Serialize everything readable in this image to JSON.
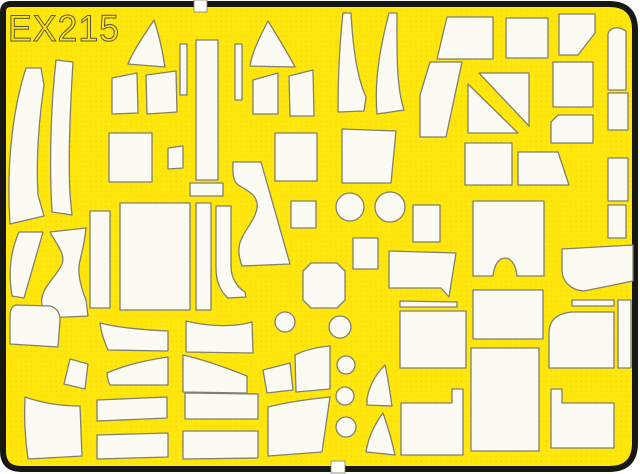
{
  "sheet": {
    "code": "EX215",
    "colors": {
      "page_background": "#ffffff",
      "sheet_yellow": "#ffe70d",
      "sheet_dot": "#f2d606",
      "part_fill": "#fbfbf3",
      "part_outline": "#80806f",
      "border_black": "#181812",
      "code_stroke": "#55554a"
    },
    "notches": [
      {
        "name": "top-edge-notch",
        "x": 194,
        "y": 0,
        "w": 13,
        "h": 12
      },
      {
        "name": "bottom-edge-notch",
        "x": 331,
        "y": 461,
        "w": 14,
        "h": 12
      }
    ],
    "parts": [
      {
        "name": "mask-crescent-left",
        "d": "M26,68 L41,68 L44,85 C39,120 36,160 38,195 L44,216 L10,224 C6,165 13,108 26,68 Z"
      },
      {
        "name": "mask-curved-strip-left",
        "d": "M56,60 L73,62 C70,110 68,155 70,195 L72,215 L52,212 C49,160 51,105 56,60 Z"
      },
      {
        "name": "mask-trapezoid-1",
        "d": "M112,78 L137,73 L138,113 L112,114 Z"
      },
      {
        "name": "mask-trapezoid-2",
        "d": "M146,75 L176,71 L177,112 L147,114 Z"
      },
      {
        "name": "mask-fin-1",
        "d": "M154,20 C143,37 133,51 128,64 L165,67 C162,47 158,32 154,20 Z"
      },
      {
        "name": "mask-thin-strip-1",
        "d": "M180,44 L187,44 L187,95 L180,95 Z"
      },
      {
        "name": "mask-thin-strip-2",
        "d": "M235,44 L242,44 L242,100 L235,100 Z"
      },
      {
        "name": "mask-tall-rect",
        "d": "M196,40 L218,40 L218,180 L196,180 Z"
      },
      {
        "name": "mask-fin-2",
        "d": "M268,21 C259,38 252,53 250,66 L295,67 C286,50 276,34 268,21 Z"
      },
      {
        "name": "mask-trapezoid-3",
        "d": "M253,80 L278,73 L278,114 L253,114 Z"
      },
      {
        "name": "mask-trapezoid-4",
        "d": "M289,76 L313,70 L314,116 L290,116 Z"
      },
      {
        "name": "mask-feather-1",
        "d": "M343,13 L351,13 C353,50 358,80 366,97 L364,111 L338,112 C338,72 340,40 343,13 Z"
      },
      {
        "name": "mask-feather-2",
        "d": "M389,13 L397,13 C397,52 396,85 404,110 L377,114 C374,78 381,44 389,13 Z"
      },
      {
        "name": "mask-rect-mid-top",
        "d": "M275,133 L317,133 L317,181 L275,181 Z"
      },
      {
        "name": "mask-trap-rect",
        "d": "M342,129 L396,131 L391,183 L342,183 Z"
      },
      {
        "name": "mask-diag-quad-a",
        "d": "M447,17 L493,17 L493,59 L437,59 Z"
      },
      {
        "name": "mask-square-b",
        "d": "M506,18 L548,18 L548,58 L506,58 Z"
      },
      {
        "name": "mask-pentagon-c",
        "d": "M559,14 L595,14 L595,33 L578,55 L559,55 Z"
      },
      {
        "name": "mask-diag-block-d",
        "d": "M420,137 L420,95 L430,62 L462,62 L446,137 Z"
      },
      {
        "name": "mask-diag-triangle-upper",
        "d": "M479,73 L529,73 L529,126 Z"
      },
      {
        "name": "mask-diag-triangle-lower",
        "d": "M468,84 L468,133 L518,133 Z"
      },
      {
        "name": "mask-corner-cut-quad",
        "d": "M558,115 L593,115 L593,143 L551,143 L551,122 Z"
      },
      {
        "name": "mask-rect-under-diag",
        "d": "M465,143 L512,143 L512,185 L465,185 Z"
      },
      {
        "name": "mask-slant-quad",
        "d": "M518,152 L558,152 L569,185 L518,185 Z"
      },
      {
        "name": "mask-edge-strip-1",
        "d": "M608,34 C609,29 614,27 620,28 L626,31 L626,90 L608,90 Z"
      },
      {
        "name": "mask-edge-strip-2",
        "d": "M608,93 L628,93 L628,130 L608,130 Z"
      },
      {
        "name": "mask-square-right",
        "d": "M553,62 L593,62 L593,107 L553,107 Z"
      },
      {
        "name": "mask-edge-strip-3",
        "d": "M608,158 L628,158 L628,201 L608,201 Z"
      },
      {
        "name": "mask-edge-strip-4",
        "d": "M608,205 L626,205 L626,238 L608,238 Z"
      },
      {
        "name": "mask-rect-above-square",
        "d": "M109,133 L152,133 L152,182 L109,182 Z"
      },
      {
        "name": "mask-small-trap",
        "d": "M168,148 L183,146 L183,168 L168,169 Z"
      },
      {
        "name": "mask-small-hrect",
        "d": "M190,183 L223,183 L223,196 L190,196 Z"
      },
      {
        "name": "mask-big-square",
        "d": "M120,203 L190,203 L190,310 L120,310 Z"
      },
      {
        "name": "mask-strip-a",
        "d": "M196,203 L211,203 L211,310 L196,310 Z"
      },
      {
        "name": "mask-strip-b-hook",
        "d": "M216,206 L231,206 L231,266 C231,278 237,287 245,292 L246,297 L228,298 C220,291 216,281 216,268 Z"
      },
      {
        "name": "mask-horn",
        "d": "M233,162 L261,162 L290,264 L242,266 C239,258 237,249 241,240 C246,228 255,220 257,208 C259,194 245,190 237,184 C232,179 233,170 233,162 Z"
      },
      {
        "name": "mask-small-square",
        "d": "M291,201 L316,201 L316,228 L291,228 Z"
      },
      {
        "name": "mask-circle-large-1",
        "cx": 350,
        "cy": 207,
        "r": 14
      },
      {
        "name": "mask-circle-large-2",
        "cx": 390,
        "cy": 207,
        "r": 15
      },
      {
        "name": "mask-small-vrect",
        "d": "M353,238 L378,238 L378,269 L353,269 Z"
      },
      {
        "name": "mask-octagon",
        "d": "M311,263 L337,263 L345,271 L345,300 L337,308 L311,308 L303,300 L303,271 Z"
      },
      {
        "name": "mask-notched-bar",
        "d": "M389,251 L456,253 L449,297 L441,288 L389,288 Z"
      },
      {
        "name": "mask-rect-center-right",
        "d": "M413,205 L440,205 L440,242 L413,242 Z"
      },
      {
        "name": "mask-arch-square",
        "d": "M473,201 L544,201 L544,276 L517,276 C516,265 511,258 505,258 C499,258 494,265 493,276 L473,276 Z"
      },
      {
        "name": "mask-wide-quad-right",
        "d": "M562,249 L633,245 L633,281 L584,291 C570,290 562,281 562,270 Z"
      },
      {
        "name": "mask-rect-center-a",
        "d": "M473,290 L543,290 L543,339 L473,339 Z"
      },
      {
        "name": "mask-thin-bar-left",
        "d": "M400,301 L457,302 L457,307 L400,307 Z"
      },
      {
        "name": "mask-big-rect-left",
        "d": "M400,311 L466,311 L466,368 L400,368 Z"
      },
      {
        "name": "mask-thin-bar-right",
        "d": "M572,300 L614,300 L614,306 L572,306 Z"
      },
      {
        "name": "mask-big-rect-right",
        "d": "M573,312 L614,312 L614,368 L549,368 L549,333 C549,319 558,313 573,312 Z"
      },
      {
        "name": "mask-edge-strip-5",
        "d": "M618,300 L631,300 L631,368 L618,368 Z"
      },
      {
        "name": "mask-wedge-left",
        "d": "M19,232 L43,232 L24,298 L12,296 C8,272 11,250 19,232 Z"
      },
      {
        "name": "mask-wave",
        "d": "M50,232 L86,228 C84,248 80,258 79,266 C78,278 82,290 86,300 L88,316 L46,318 C42,308 40,300 43,294 C46,284 58,274 62,264 C66,254 56,244 50,232 Z"
      },
      {
        "name": "mask-strip-c",
        "d": "M90,211 L110,211 L110,308 L90,308 Z"
      },
      {
        "name": "mask-round-quad",
        "d": "M16,305 L50,306 C57,308 60,313 60,320 L58,347 L10,344 L10,316 C10,310 12,306 16,305 Z"
      },
      {
        "name": "mask-blade-1",
        "d": "M100,323 C120,328 144,330 168,331 L168,351 L108,350 C104,341 101,332 100,323 Z"
      },
      {
        "name": "mask-wide-bar-1",
        "d": "M186,321 C210,327 235,327 252,322 L253,353 L186,352 Z"
      },
      {
        "name": "mask-tilted-quad",
        "d": "M70,359 L88,364 L85,389 L64,384 Z"
      },
      {
        "name": "mask-blade-2",
        "d": "M107,373 C125,365 147,360 168,357 L168,385 L110,385 C108,381 107,377 107,373 Z"
      },
      {
        "name": "mask-wide-bar-2",
        "d": "M183,355 C205,360 227,368 247,376 L247,393 L183,392 Z"
      },
      {
        "name": "mask-big-quad-bl",
        "d": "M25,397 C45,404 62,406 80,406 L82,456 L28,459 C25,438 24,416 25,397 Z"
      },
      {
        "name": "mask-rect-row1-a",
        "d": "M97,400 L167,397 L167,418 L97,421 Z"
      },
      {
        "name": "mask-rect-row1-b",
        "d": "M185,393 L258,394 L258,419 L185,419 Z"
      },
      {
        "name": "mask-rect-row2-a",
        "d": "M97,435 L168,433 L168,457 L97,459 Z"
      },
      {
        "name": "mask-rect-row2-b",
        "d": "M183,431 L258,431 L258,458 L183,459 Z"
      },
      {
        "name": "mask-tilt-quad-2",
        "d": "M263,370 L290,363 L293,390 L267,393 Z"
      },
      {
        "name": "mask-tilt-quad-3",
        "d": "M295,355 C305,350 318,347 330,346 L330,389 L296,392 Z"
      },
      {
        "name": "mask-big-quad-bc",
        "d": "M268,407 C288,402 310,399 330,397 L322,452 L268,456 Z"
      },
      {
        "name": "mask-circle-small-0",
        "cx": 285,
        "cy": 322,
        "r": 10
      },
      {
        "name": "mask-circle-small-1",
        "cx": 340,
        "cy": 327,
        "r": 11
      },
      {
        "name": "mask-circle-small-2",
        "cx": 346,
        "cy": 365,
        "r": 9
      },
      {
        "name": "mask-circle-small-3",
        "cx": 345,
        "cy": 396,
        "r": 9
      },
      {
        "name": "mask-circle-small-4",
        "cx": 346,
        "cy": 427,
        "r": 10
      },
      {
        "name": "mask-sail-1",
        "d": "M385,365 C375,375 369,387 367,399 L367,405 L392,406 C390,392 388,378 385,365 Z"
      },
      {
        "name": "mask-sail-2",
        "d": "M383,413 C374,425 368,439 366,452 L395,455 C392,441 388,427 383,413 Z"
      },
      {
        "name": "mask-step-rect-left",
        "d": "M401,403 L452,403 L452,389 L463,389 L463,455 L401,455 Z"
      },
      {
        "name": "mask-step-rect-right",
        "d": "M551,389 L562,389 L562,403 L614,403 L614,448 L551,448 Z"
      },
      {
        "name": "mask-big-rect-bc",
        "d": "M471,348 L539,348 L539,451 L471,451 Z"
      }
    ]
  }
}
